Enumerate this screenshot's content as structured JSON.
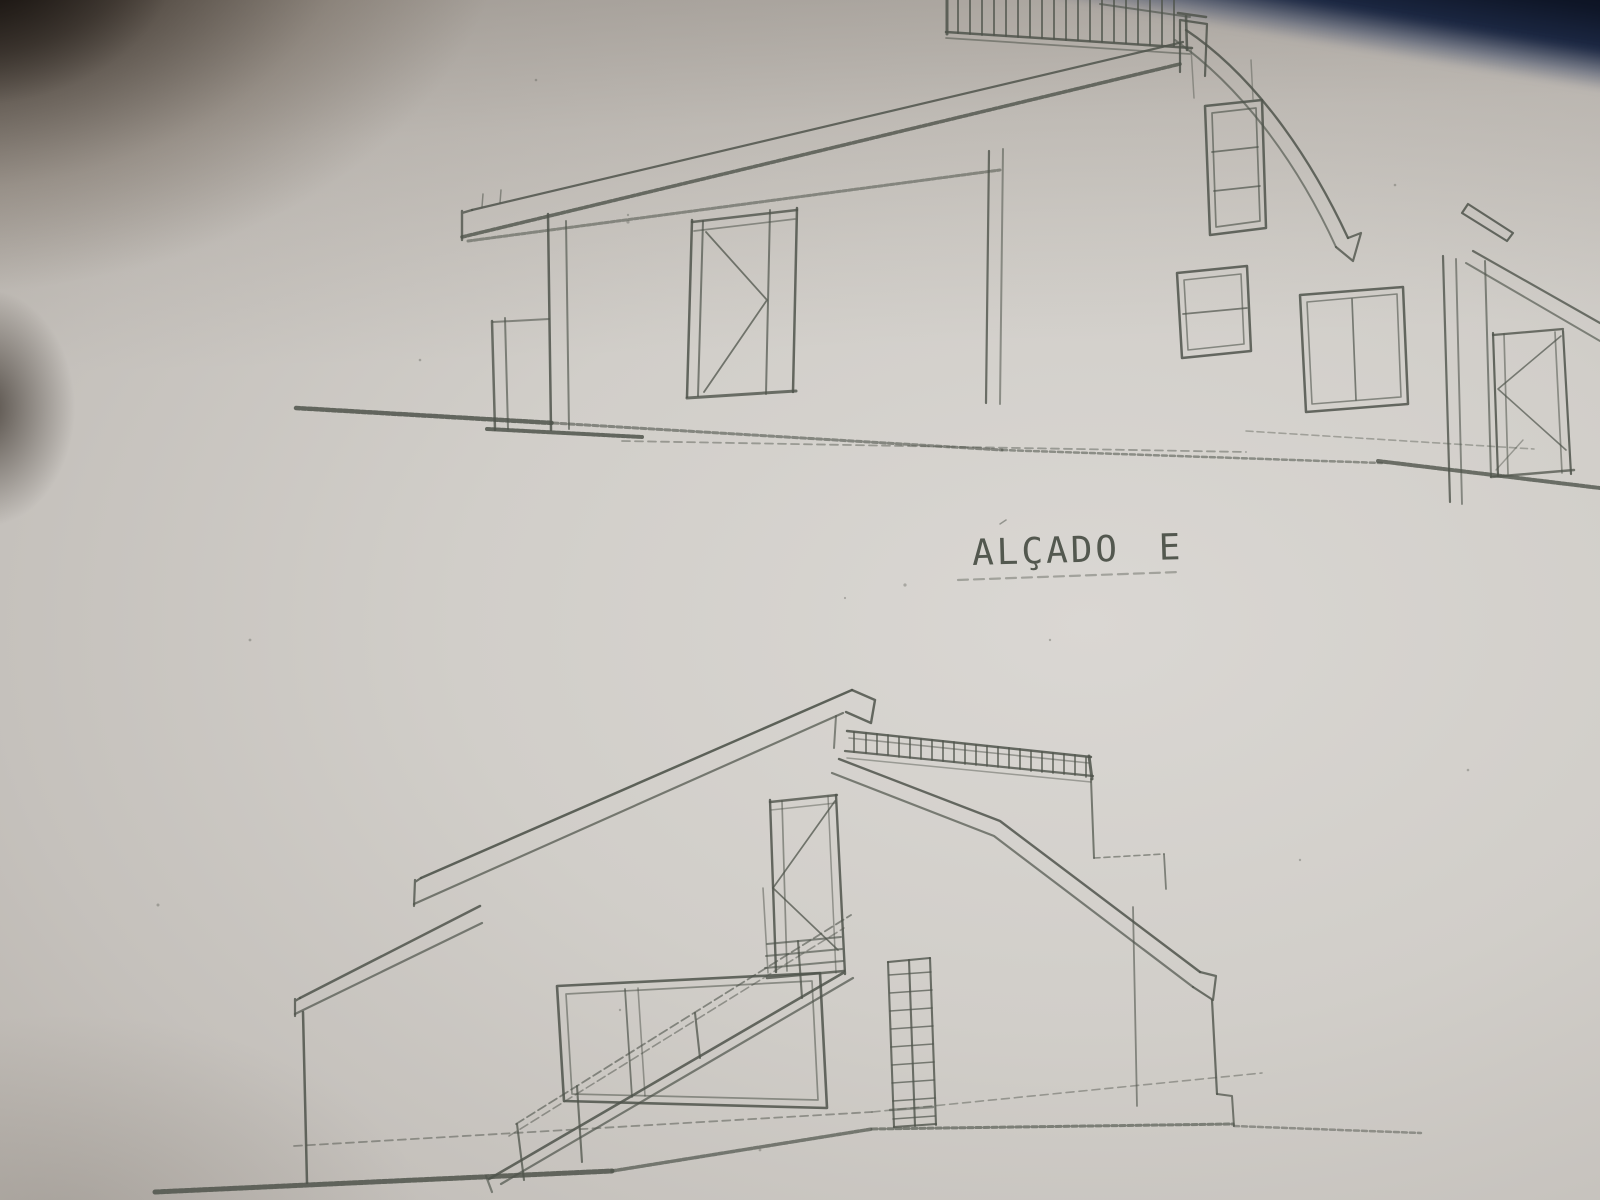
{
  "photo": {
    "paper_color": "#d2cfca",
    "pencil_color": "#4f544b",
    "corner_shadow_color": "#1a130e",
    "photo_edge_stripe_color": "#101b33"
  },
  "caption": {
    "text": "ALÇADO E"
  },
  "drawings": {
    "upper_elevation": {
      "label": "upper house elevation (cut off at top of photo)",
      "features": [
        "raking shed-roof fascia band",
        "left wall with stepped base",
        "entry door with swing diagonals",
        "roof-deck railing with balusters",
        "ridge post",
        "curved gable roof with end cap",
        "tall three-pane window",
        "small two-pane window",
        "wide two-pane window",
        "rear annex with shed roof cap",
        "annex door with swing diagonals",
        "sloping hatched ground line",
        "dashed floor line"
      ]
    },
    "lower_elevation": {
      "label": "lower house elevation",
      "features": [
        "long raking fascia in two offset sections",
        "ridge cap",
        "roof-deck railing with balusters",
        "stepped parapet below railing",
        "descending shed-roof band with end fascia",
        "upper-level door with swing diagonals and steps",
        "external stair ramp with handrail and posts",
        "wide sliding window with centre mullion",
        "tall grille window",
        "stepped right wall base",
        "sloping hatched ground lines",
        "dashed upper ground line"
      ]
    }
  }
}
